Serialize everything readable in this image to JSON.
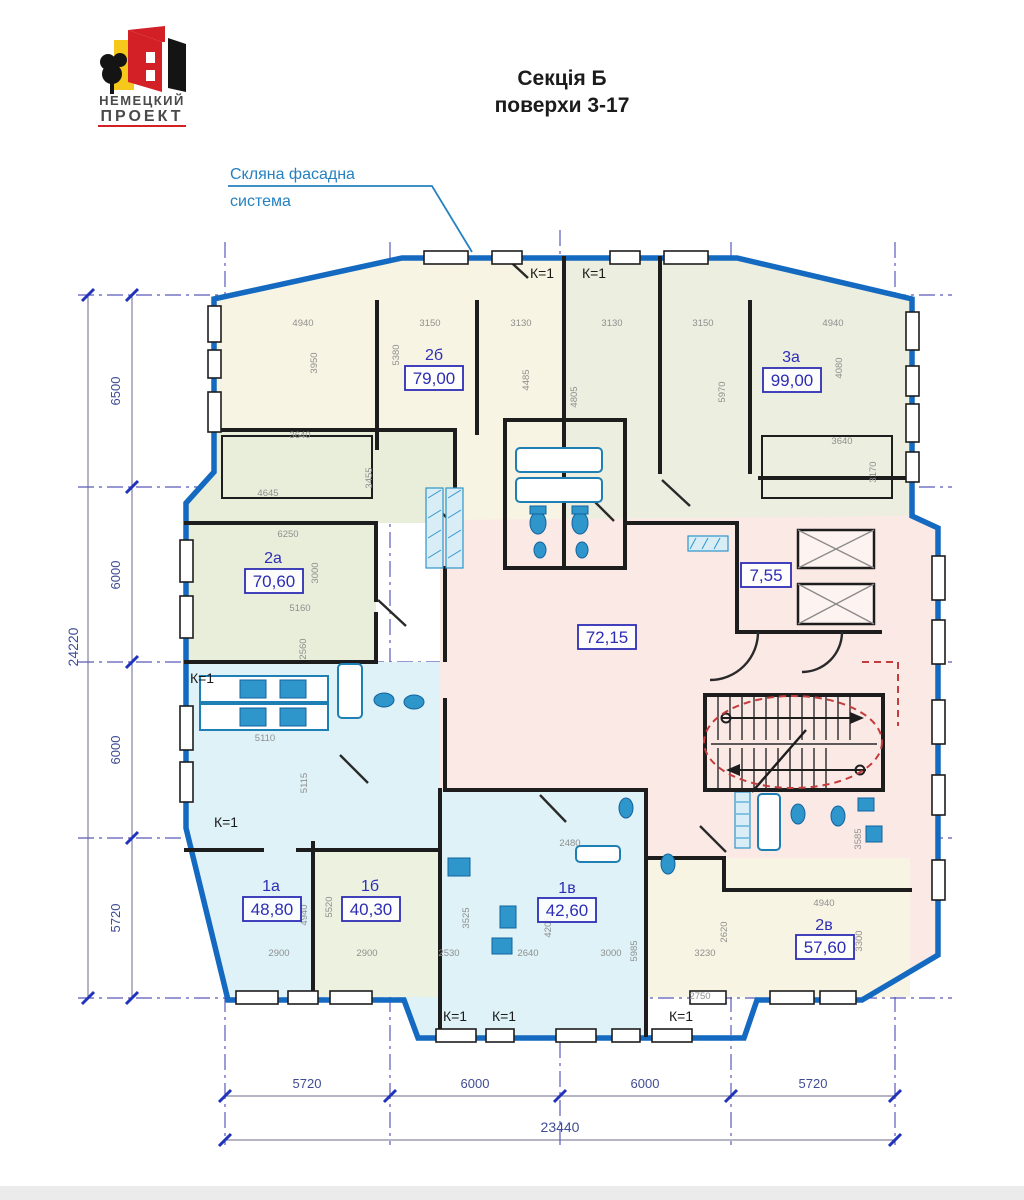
{
  "logo": {
    "line1": "НЕМЕЦКИЙ",
    "line2": "ПРОЕКТ"
  },
  "title": {
    "line1": "Секція Б",
    "line2": "поверхи 3-17"
  },
  "annotation": {
    "line1": "Скляна фасадна",
    "line2": "система"
  },
  "k": "К=1",
  "core": {
    "lobby": "7,55",
    "corridor": "72,15"
  },
  "apartments": [
    {
      "code": "2б",
      "area": "79,00"
    },
    {
      "code": "3а",
      "area": "99,00"
    },
    {
      "code": "2а",
      "area": "70,60"
    },
    {
      "code": "1а",
      "area": "48,80"
    },
    {
      "code": "1б",
      "area": "40,30"
    },
    {
      "code": "1в",
      "area": "42,60"
    },
    {
      "code": "2в",
      "area": "57,60"
    }
  ],
  "dimensions": {
    "left_total": "24220",
    "left_segments": [
      "6500",
      "6000",
      "6000",
      "5720"
    ],
    "bottom_segments": [
      "5720",
      "6000",
      "6000",
      "5720"
    ],
    "bottom_total": "23440",
    "interior": [
      "4940",
      "3150",
      "3130",
      "3130",
      "3150",
      "4940",
      "3950",
      "5380",
      "4485",
      "4805",
      "5970",
      "4080",
      "3640",
      "3455",
      "4645",
      "3640",
      "3170",
      "6250",
      "3000",
      "5160",
      "2560",
      "5110",
      "5115",
      "2900",
      "2900",
      "2530",
      "2640",
      "3000",
      "3230",
      "4940",
      "5520",
      "3525",
      "4205",
      "5985",
      "2620",
      "3300",
      "4940",
      "3585",
      "2480",
      "2750"
    ]
  }
}
